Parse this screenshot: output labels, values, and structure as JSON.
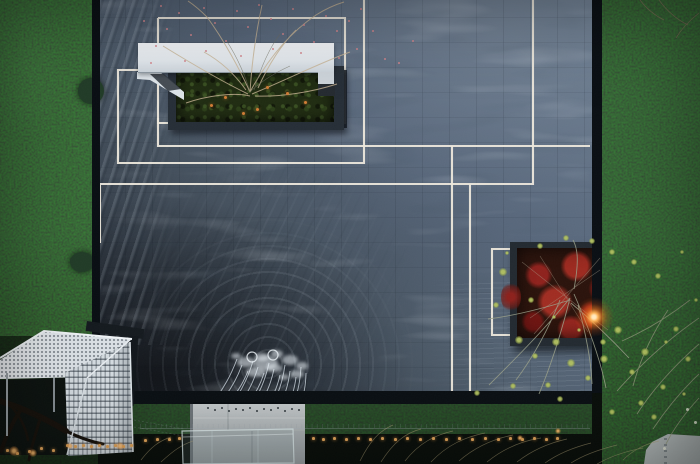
{
  "scene": {
    "description": "Dusk aerial view of a minimalist courtyard reflecting pool framed by hedges, with a white cantilevered bench over a tree planter, warm LED light lines inset in dark paving, a red-foliage planter with a glowing lantern, a white lattice pavilion, and a concrete fountain cube shooting arcs of water",
    "time_of_day": "dusk",
    "view": "top-down aerial"
  },
  "palette": {
    "water_light": "#6b7c90",
    "water_dark": "#232933",
    "hedge": "#1d3424",
    "edge_dark": "#0a0f14",
    "light_line": "#ece7db",
    "bench_white": "#eef1f4",
    "planter_green": "#202c12",
    "red_foliage": "#8e221d",
    "lamp_glow": "#ff8c3a",
    "string_light": "#e2a55a",
    "berry": "#d2848b",
    "ember": "#d07c35",
    "leaf_yellow": "#a9b757",
    "concrete": "#b7bcbe",
    "lattice_white": "#d9dfe4",
    "pavement": "#aab1b1"
  },
  "light_lines": {
    "color": "#ece7db",
    "width": 2.1,
    "paths": [
      [
        [
          158,
          18
        ],
        [
          345,
          18
        ],
        [
          345,
          123
        ],
        [
          158,
          123
        ],
        [
          158,
          18
        ]
      ],
      [
        [
          158,
          118
        ],
        [
          158,
          146
        ],
        [
          590,
          146
        ]
      ],
      [
        [
          364,
          -2
        ],
        [
          364,
          163
        ],
        [
          118,
          163
        ],
        [
          118,
          70
        ],
        [
          141,
          70
        ]
      ],
      [
        [
          533,
          -2
        ],
        [
          533,
          184
        ],
        [
          100,
          184
        ],
        [
          100,
          243
        ]
      ],
      [
        [
          452,
          146
        ],
        [
          452,
          393
        ]
      ],
      [
        [
          470,
          184
        ],
        [
          470,
          393
        ]
      ],
      [
        [
          517,
          249
        ],
        [
          492,
          249
        ],
        [
          492,
          335
        ],
        [
          512,
          335
        ]
      ]
    ]
  },
  "red_planter": {
    "lamp": {
      "x": 594,
      "y": 317
    }
  },
  "fountain": {
    "nozzles": [
      [
        207,
        407
      ],
      [
        214,
        409
      ],
      [
        221,
        407
      ],
      [
        228,
        410
      ],
      [
        235,
        408
      ],
      [
        242,
        409
      ],
      [
        249,
        407
      ],
      [
        256,
        410
      ],
      [
        263,
        408
      ],
      [
        270,
        409
      ],
      [
        277,
        407
      ],
      [
        284,
        410
      ],
      [
        291,
        408
      ],
      [
        298,
        409
      ]
    ],
    "jets": [
      [
        206,
        409,
        237,
        359
      ],
      [
        213,
        409,
        242,
        365
      ],
      [
        220,
        409,
        248,
        371
      ],
      [
        227,
        409,
        253,
        361
      ],
      [
        234,
        409,
        258,
        367
      ],
      [
        241,
        409,
        264,
        373
      ],
      [
        248,
        409,
        269,
        363
      ],
      [
        255,
        409,
        274,
        369
      ],
      [
        262,
        409,
        280,
        375
      ],
      [
        269,
        409,
        285,
        365
      ],
      [
        276,
        409,
        290,
        371
      ],
      [
        283,
        409,
        296,
        377
      ],
      [
        290,
        409,
        301,
        367
      ],
      [
        297,
        409,
        306,
        373
      ]
    ],
    "splash_blobs": [
      [
        246,
        362,
        9,
        5
      ],
      [
        262,
        357,
        7,
        4
      ],
      [
        277,
        354,
        6,
        4
      ],
      [
        290,
        360,
        8,
        5
      ],
      [
        302,
        366,
        6,
        4
      ],
      [
        256,
        372,
        10,
        5
      ],
      [
        274,
        368,
        8,
        4
      ],
      [
        236,
        356,
        5,
        3
      ],
      [
        297,
        374,
        7,
        4
      ],
      [
        284,
        377,
        5,
        3
      ],
      [
        266,
        363,
        12,
        7
      ]
    ],
    "splash_rings": [
      [
        252,
        357,
        5
      ],
      [
        273,
        355,
        5
      ]
    ]
  },
  "string_lights": {
    "dots": [
      [
        6,
        449
      ],
      [
        16,
        452
      ],
      [
        28,
        450
      ],
      [
        40,
        447
      ],
      [
        52,
        449
      ],
      [
        66,
        444
      ],
      [
        74,
        445
      ],
      [
        82,
        444
      ],
      [
        90,
        445
      ],
      [
        98,
        444
      ],
      [
        106,
        445
      ],
      [
        114,
        444
      ],
      [
        122,
        445
      ],
      [
        130,
        444
      ],
      [
        144,
        439
      ],
      [
        156,
        438
      ],
      [
        168,
        438
      ],
      [
        178,
        437
      ],
      [
        312,
        437
      ],
      [
        322,
        438
      ],
      [
        333,
        437
      ],
      [
        345,
        438
      ],
      [
        357,
        437
      ],
      [
        369,
        438
      ],
      [
        381,
        437
      ],
      [
        394,
        438
      ],
      [
        406,
        437
      ],
      [
        419,
        438
      ],
      [
        432,
        437
      ],
      [
        445,
        438
      ],
      [
        458,
        437
      ],
      [
        471,
        438
      ],
      [
        484,
        437
      ],
      [
        497,
        438
      ],
      [
        509,
        437
      ],
      [
        521,
        438
      ],
      [
        533,
        437
      ],
      [
        545,
        438
      ],
      [
        556,
        437
      ]
    ],
    "glows": [
      [
        14,
        451,
        5
      ],
      [
        33,
        453,
        4
      ],
      [
        70,
        446,
        3
      ],
      [
        120,
        446,
        4
      ],
      [
        520,
        438,
        3
      ],
      [
        558,
        431,
        3
      ]
    ]
  },
  "berries": {
    "dots": [
      [
        166,
        28
      ],
      [
        178,
        12
      ],
      [
        190,
        34
      ],
      [
        203,
        7
      ],
      [
        214,
        22
      ],
      [
        225,
        40
      ],
      [
        236,
        10
      ],
      [
        247,
        26
      ],
      [
        258,
        4
      ],
      [
        270,
        18
      ],
      [
        282,
        33
      ],
      [
        292,
        8
      ],
      [
        303,
        24
      ],
      [
        313,
        41
      ],
      [
        325,
        15
      ],
      [
        336,
        30
      ],
      [
        348,
        20
      ],
      [
        356,
        48
      ],
      [
        338,
        57
      ],
      [
        384,
        58
      ],
      [
        300,
        52
      ],
      [
        272,
        48
      ],
      [
        240,
        55
      ],
      [
        205,
        50
      ],
      [
        184,
        60
      ],
      [
        155,
        45
      ],
      [
        150,
        62
      ],
      [
        360,
        8
      ],
      [
        372,
        30
      ],
      [
        398,
        62
      ],
      [
        412,
        40
      ],
      [
        160,
        5
      ],
      [
        143,
        20
      ]
    ]
  },
  "planter_embers": {
    "dots": [
      [
        224,
        96
      ],
      [
        256,
        108
      ],
      [
        286,
        92
      ],
      [
        242,
        112
      ],
      [
        304,
        101
      ],
      [
        210,
        104
      ],
      [
        266,
        86
      ]
    ]
  },
  "leaf_clusters": {
    "dots": [
      [
        503,
        272,
        4
      ],
      [
        496,
        305,
        3
      ],
      [
        519,
        340,
        4
      ],
      [
        535,
        356,
        3
      ],
      [
        556,
        342,
        4
      ],
      [
        571,
        363,
        4
      ],
      [
        588,
        378,
        3
      ],
      [
        604,
        359,
        4
      ],
      [
        548,
        385,
        3
      ],
      [
        513,
        386,
        3
      ],
      [
        477,
        393,
        3
      ],
      [
        560,
        399,
        3
      ],
      [
        618,
        330,
        4
      ],
      [
        645,
        352,
        4
      ],
      [
        663,
        387,
        3
      ],
      [
        676,
        329,
        3
      ],
      [
        688,
        359,
        3
      ],
      [
        641,
        403,
        3
      ],
      [
        612,
        412,
        3
      ],
      [
        654,
        417,
        3
      ],
      [
        603,
        342,
        3
      ],
      [
        632,
        372,
        3
      ],
      [
        666,
        342,
        2
      ],
      [
        684,
        394,
        2
      ],
      [
        540,
        246,
        3
      ],
      [
        566,
        238,
        3
      ],
      [
        592,
        241,
        3
      ],
      [
        612,
        252,
        3
      ],
      [
        634,
        262,
        3
      ],
      [
        658,
        276,
        3
      ],
      [
        682,
        252,
        2
      ],
      [
        696,
        300,
        2
      ],
      [
        507,
        253,
        2
      ],
      [
        531,
        300,
        3
      ],
      [
        554,
        317,
        2
      ],
      [
        579,
        330,
        2
      ]
    ]
  },
  "flowers": {
    "dots": [
      [
        686,
        408
      ],
      [
        694,
        421
      ],
      [
        663,
        447
      ]
    ]
  }
}
